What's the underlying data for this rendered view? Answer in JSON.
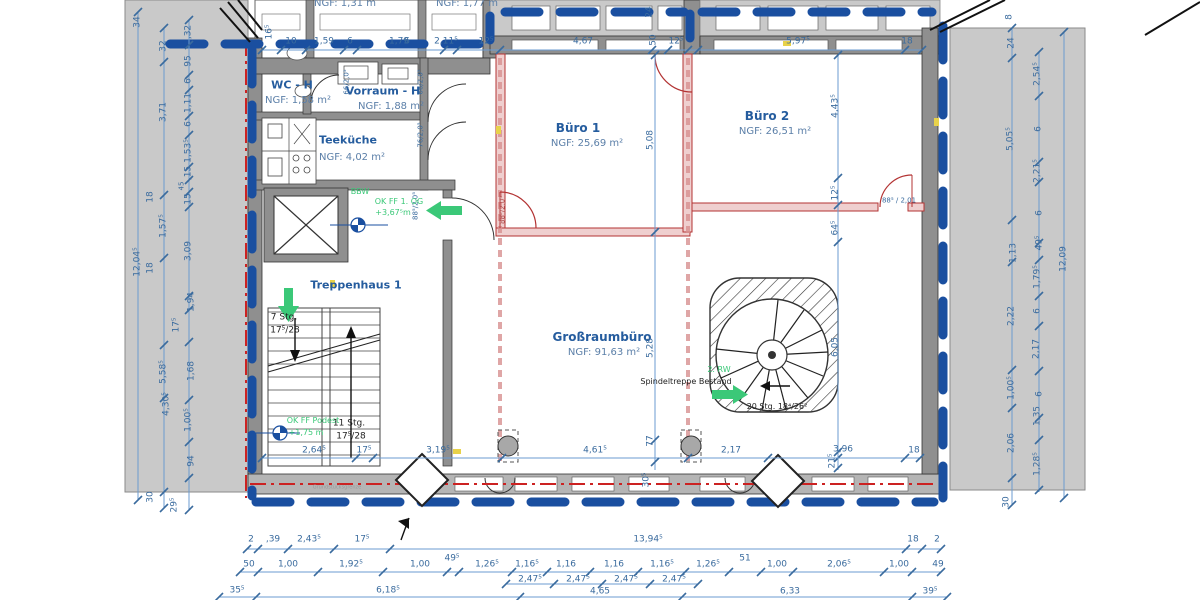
{
  "palette": {
    "d": "#3a6b9e",
    "r": "#255c9e",
    "n": "#5b7fa8",
    "g": "#3bc878",
    "k": "#222222",
    "y": "#999999",
    "p": "#b05050"
  },
  "colors": {
    "envelope_blue": "#1a4fa0",
    "property_line_red": "#cc2222",
    "wall_gray": "#8f8f8f",
    "parapet_gray": "#c9c9c9",
    "neighbor_gray": "#c9c9c9",
    "new_wall_red": "#b33333",
    "dim_line": "#6b9bd0",
    "accent_yellow": "#e8d24a",
    "green": "#3bc878"
  },
  "rooms": [
    {
      "name": "WC - H",
      "ngf": "NGF: 1,58 m²"
    },
    {
      "name": "Vorraum - H",
      "ngf": "NGF: 1,88 m²"
    },
    {
      "name": "Teeküche",
      "ngf": "NGF: 4,02 m²"
    },
    {
      "name": "Büro 1",
      "ngf": "NGF: 25,69 m²"
    },
    {
      "name": "Büro 2",
      "ngf": "NGF: 26,51 m²"
    },
    {
      "name": "Großraumbüro",
      "ngf": "NGF: 91,63 m²"
    },
    {
      "name": "Treppenhaus 1",
      "ngf": ""
    }
  ],
  "labels": [
    {
      "t": "NGF: 1,31 m",
      "x": 345,
      "y": 4,
      "s": 10,
      "c": "n",
      "n": "ngf-top-room-1"
    },
    {
      "t": "NGF: 1,77 m",
      "x": 467,
      "y": 4,
      "s": 10,
      "c": "n",
      "n": "ngf-top-room-2"
    },
    {
      "t": "16⁵",
      "x": 270,
      "y": 32,
      "v": 1
    },
    {
      "t": "10",
      "x": 291,
      "y": 42
    },
    {
      "t": "1,59",
      "x": 324,
      "y": 42
    },
    {
      "t": "6",
      "x": 350,
      "y": 42
    },
    {
      "t": "1,79",
      "x": 399,
      "y": 42
    },
    {
      "t": "6",
      "x": 407,
      "y": 42
    },
    {
      "t": "2,11⁵",
      "x": 446,
      "y": 42
    },
    {
      "t": "12⁵",
      "x": 486,
      "y": 42
    },
    {
      "t": "4,67",
      "x": 583,
      "y": 42
    },
    {
      "t": "50",
      "x": 654,
      "y": 40,
      "v": 1
    },
    {
      "t": "12⁵",
      "x": 676,
      "y": 42
    },
    {
      "t": "5,97⁵",
      "x": 798,
      "y": 42
    },
    {
      "t": "18",
      "x": 907,
      "y": 42
    },
    {
      "t": "24",
      "x": 650,
      "y": 12,
      "v": 1
    },
    {
      "t": "66/2,0⁵",
      "x": 347,
      "y": 82,
      "s": 7,
      "v": 1,
      "n": "door-size-label"
    },
    {
      "t": "66/2,0⁵",
      "x": 421,
      "y": 82,
      "s": 7,
      "v": 1,
      "n": "door-size-label"
    },
    {
      "t": "76/2,0⁵",
      "x": 421,
      "y": 135,
      "s": 7,
      "v": 1,
      "n": "door-size-label"
    },
    {
      "t": "88⁵/2,0⁵",
      "x": 416,
      "y": 206,
      "s": 7,
      "v": 1,
      "n": "door-size-label"
    },
    {
      "t": "88⁵/2,0⁵",
      "x": 503,
      "y": 210,
      "s": 7,
      "v": 1,
      "c": "p",
      "n": "door-size-label"
    },
    {
      "t": "88⁵ / 2,01",
      "x": 899,
      "y": 201,
      "s": 7,
      "n": "door-size-label"
    },
    {
      "t": "WC - H",
      "x": 292,
      "y": 85,
      "s": 11,
      "c": "r",
      "b": 1,
      "n": "room-label-wc-h"
    },
    {
      "t": "NGF: 1,58 m²",
      "x": 298,
      "y": 101,
      "s": 10,
      "c": "n",
      "n": "room-area-wc-h"
    },
    {
      "t": "Vorraum - H",
      "x": 383,
      "y": 91,
      "s": 11,
      "c": "r",
      "b": 1,
      "n": "room-label-vorraum-h"
    },
    {
      "t": "NGF: 1,88 m²",
      "x": 391,
      "y": 107,
      "s": 10,
      "c": "n",
      "n": "room-area-vorraum-h"
    },
    {
      "t": "Teeküche",
      "x": 348,
      "y": 140,
      "s": 11,
      "c": "r",
      "b": 1,
      "n": "room-label-teekueche"
    },
    {
      "t": "NGF: 4,02 m²",
      "x": 352,
      "y": 158,
      "s": 10,
      "c": "n",
      "n": "room-area-teekueche"
    },
    {
      "t": "Büro 1",
      "x": 578,
      "y": 128,
      "s": 12,
      "c": "r",
      "b": 1,
      "n": "room-label-buero-1"
    },
    {
      "t": "NGF: 25,69 m²",
      "x": 587,
      "y": 144,
      "s": 10,
      "c": "n",
      "n": "room-area-buero-1"
    },
    {
      "t": "Büro 2",
      "x": 767,
      "y": 116,
      "s": 12,
      "c": "r",
      "b": 1,
      "n": "room-label-buero-2"
    },
    {
      "t": "NGF: 26,51 m²",
      "x": 775,
      "y": 132,
      "s": 10,
      "c": "n",
      "n": "room-area-buero-2"
    },
    {
      "t": "Großraumbüro",
      "x": 602,
      "y": 337,
      "s": 12,
      "c": "r",
      "b": 1,
      "n": "room-label-grossraumbuero"
    },
    {
      "t": "NGF: 91,63 m²",
      "x": 604,
      "y": 353,
      "s": 10,
      "c": "n",
      "n": "room-area-grossraumbuero"
    },
    {
      "t": "Treppenhaus 1",
      "x": 356,
      "y": 285,
      "s": 11,
      "c": "r",
      "b": 1,
      "n": "room-label-treppenhaus-1"
    },
    {
      "t": "BBW",
      "x": 360,
      "y": 192,
      "s": 8,
      "c": "g",
      "n": "note-bbw"
    },
    {
      "t": "OK FF 1. OG",
      "x": 399,
      "y": 202,
      "s": 8,
      "c": "g",
      "n": "level-note-ok-ff-1og"
    },
    {
      "t": "+3,67⁵m",
      "x": 393,
      "y": 213,
      "s": 8,
      "c": "g",
      "n": "level-value-1og"
    },
    {
      "t": "OK FF Podest",
      "x": 313,
      "y": 421,
      "s": 8,
      "c": "g",
      "n": "level-note-podest"
    },
    {
      "t": "+1,75 m",
      "x": 306,
      "y": 433,
      "s": 8,
      "c": "g",
      "n": "level-value-podest"
    },
    {
      "t": "7 Stg.",
      "x": 284,
      "y": 318,
      "s": 9,
      "c": "k",
      "n": "stair-note-7stg"
    },
    {
      "t": "17⁵/28",
      "x": 285,
      "y": 331,
      "s": 9,
      "c": "k",
      "n": "stair-note-7stg-dim"
    },
    {
      "t": "11 Stg.",
      "x": 349,
      "y": 424,
      "s": 9,
      "c": "k",
      "n": "stair-note-11stg"
    },
    {
      "t": "17⁵/28",
      "x": 351,
      "y": 437,
      "s": 9,
      "c": "k",
      "n": "stair-note-11stg-dim"
    },
    {
      "t": "2. RW",
      "x": 719,
      "y": 370,
      "s": 8,
      "c": "g",
      "n": "note-2-rw"
    },
    {
      "t": "Spindeltreppe Bestand",
      "x": 686,
      "y": 382,
      "s": 8,
      "c": "k",
      "n": "note-spindeltreppe"
    },
    {
      "t": "20 Stg. 18⁴/26²",
      "x": 777,
      "y": 407,
      "s": 8,
      "c": "k",
      "n": "stair-note-20stg"
    },
    {
      "t": "Grundstücksgrenze",
      "x": 337,
      "y": 488,
      "s": 5,
      "c": "y",
      "n": "note-grundstuecksgrenze"
    },
    {
      "t": "5,08",
      "x": 651,
      "y": 140,
      "v": 1
    },
    {
      "t": "5,28",
      "x": 651,
      "y": 348,
      "v": 1
    },
    {
      "t": "77",
      "x": 651,
      "y": 441,
      "v": 1
    },
    {
      "t": "30⁵",
      "x": 647,
      "y": 480,
      "v": 1
    },
    {
      "t": "4,43⁵",
      "x": 836,
      "y": 106,
      "v": 1
    },
    {
      "t": "12⁵",
      "x": 836,
      "y": 193,
      "v": 1
    },
    {
      "t": "64⁵",
      "x": 836,
      "y": 228,
      "v": 1
    },
    {
      "t": "6,05",
      "x": 836,
      "y": 347,
      "v": 1
    },
    {
      "t": "21⁵",
      "x": 833,
      "y": 461,
      "v": 1
    },
    {
      "t": "2,64⁵",
      "x": 314,
      "y": 451
    },
    {
      "t": "17⁵",
      "x": 364,
      "y": 451
    },
    {
      "t": "3,19⁵",
      "x": 438,
      "y": 451
    },
    {
      "t": "4,61⁵",
      "x": 595,
      "y": 451
    },
    {
      "t": "2,17",
      "x": 731,
      "y": 451
    },
    {
      "t": "3,96",
      "x": 843,
      "y": 450
    },
    {
      "t": "18",
      "x": 914,
      "y": 451
    },
    {
      "t": "34",
      "x": 138,
      "y": 22,
      "v": 1
    },
    {
      "t": "12,04⁵",
      "x": 138,
      "y": 262,
      "v": 1
    },
    {
      "t": "32",
      "x": 164,
      "y": 46,
      "v": 1
    },
    {
      "t": "3,71",
      "x": 164,
      "y": 112,
      "v": 1
    },
    {
      "t": "1,57⁵",
      "x": 164,
      "y": 226,
      "v": 1
    },
    {
      "t": "18",
      "x": 151,
      "y": 197,
      "v": 1
    },
    {
      "t": "18",
      "x": 151,
      "y": 268,
      "v": 1
    },
    {
      "t": "5,58⁵",
      "x": 164,
      "y": 372,
      "v": 1
    },
    {
      "t": "4,30⁵",
      "x": 167,
      "y": 404,
      "v": 1
    },
    {
      "t": "30",
      "x": 151,
      "y": 497,
      "v": 1
    },
    {
      "t": ",32",
      "x": 189,
      "y": 32,
      "v": 1
    },
    {
      "t": "95",
      "x": 189,
      "y": 61,
      "v": 1
    },
    {
      "t": "6",
      "x": 189,
      "y": 81,
      "v": 1
    },
    {
      "t": "1,11",
      "x": 189,
      "y": 103,
      "v": 1
    },
    {
      "t": "6",
      "x": 189,
      "y": 124,
      "v": 1
    },
    {
      "t": "1,53⁵",
      "x": 189,
      "y": 151,
      "v": 1
    },
    {
      "t": ",15",
      "x": 189,
      "y": 173,
      "v": 1
    },
    {
      "t": "45",
      "x": 182,
      "y": 186,
      "s": 7,
      "v": 1
    },
    {
      "t": "15",
      "x": 189,
      "y": 199,
      "v": 1
    },
    {
      "t": "3,09",
      "x": 189,
      "y": 251,
      "v": 1
    },
    {
      "t": "1,94",
      "x": 192,
      "y": 302,
      "v": 1
    },
    {
      "t": "17⁵",
      "x": 177,
      "y": 325,
      "v": 1
    },
    {
      "t": "1,68",
      "x": 192,
      "y": 371,
      "v": 1
    },
    {
      "t": "1,00⁵",
      "x": 189,
      "y": 420,
      "v": 1
    },
    {
      "t": "94",
      "x": 192,
      "y": 461,
      "v": 1
    },
    {
      "t": "29⁵",
      "x": 175,
      "y": 505,
      "v": 1
    },
    {
      "t": "8",
      "x": 1010,
      "y": 17,
      "v": 1
    },
    {
      "t": "24",
      "x": 1012,
      "y": 43,
      "v": 1
    },
    {
      "t": "5,05⁵",
      "x": 1011,
      "y": 139,
      "v": 1
    },
    {
      "t": "1,13",
      "x": 1014,
      "y": 253,
      "v": 1
    },
    {
      "t": "2,22",
      "x": 1012,
      "y": 316,
      "v": 1
    },
    {
      "t": "1,00⁵",
      "x": 1012,
      "y": 388,
      "v": 1
    },
    {
      "t": "2,06",
      "x": 1012,
      "y": 443,
      "v": 1
    },
    {
      "t": "30",
      "x": 1007,
      "y": 502,
      "v": 1
    },
    {
      "t": "2,54⁵",
      "x": 1038,
      "y": 74,
      "v": 1
    },
    {
      "t": "6",
      "x": 1039,
      "y": 129,
      "v": 1
    },
    {
      "t": "2,21⁵",
      "x": 1038,
      "y": 171,
      "v": 1
    },
    {
      "t": "6",
      "x": 1040,
      "y": 213,
      "v": 1
    },
    {
      "t": "49⁵",
      "x": 1040,
      "y": 243,
      "v": 1
    },
    {
      "t": "1,79⁵",
      "x": 1038,
      "y": 277,
      "v": 1
    },
    {
      "t": "6",
      "x": 1038,
      "y": 311,
      "v": 1
    },
    {
      "t": "2,17",
      "x": 1037,
      "y": 349,
      "v": 1
    },
    {
      "t": "6",
      "x": 1040,
      "y": 394,
      "v": 1
    },
    {
      "t": "1,35",
      "x": 1038,
      "y": 416,
      "v": 1
    },
    {
      "t": "1,28⁵",
      "x": 1038,
      "y": 464,
      "v": 1
    },
    {
      "t": "12,09",
      "x": 1064,
      "y": 259,
      "v": 1
    },
    {
      "t": "2",
      "x": 251,
      "y": 540
    },
    {
      "t": ",39",
      "x": 273,
      "y": 540
    },
    {
      "t": "2,43⁵",
      "x": 309,
      "y": 540
    },
    {
      "t": "17⁵",
      "x": 362,
      "y": 540
    },
    {
      "t": "13,94⁵",
      "x": 648,
      "y": 540
    },
    {
      "t": "18",
      "x": 913,
      "y": 540
    },
    {
      "t": "2",
      "x": 937,
      "y": 540
    },
    {
      "t": "50",
      "x": 249,
      "y": 565
    },
    {
      "t": "1,00",
      "x": 288,
      "y": 565
    },
    {
      "t": "1,92⁵",
      "x": 351,
      "y": 565
    },
    {
      "t": "1,00",
      "x": 420,
      "y": 565
    },
    {
      "t": "49⁵",
      "x": 452,
      "y": 559
    },
    {
      "t": "1,26⁵",
      "x": 487,
      "y": 565
    },
    {
      "t": "1,16⁵",
      "x": 527,
      "y": 565
    },
    {
      "t": "1,16",
      "x": 566,
      "y": 565
    },
    {
      "t": "1,16",
      "x": 614,
      "y": 565
    },
    {
      "t": "1,16⁵",
      "x": 662,
      "y": 565
    },
    {
      "t": "1,26⁵",
      "x": 708,
      "y": 565
    },
    {
      "t": "51",
      "x": 745,
      "y": 559
    },
    {
      "t": "1,00",
      "x": 777,
      "y": 565
    },
    {
      "t": "2,06⁵",
      "x": 839,
      "y": 565
    },
    {
      "t": "1,00",
      "x": 899,
      "y": 565
    },
    {
      "t": "49",
      "x": 938,
      "y": 565
    },
    {
      "t": "2,47⁵",
      "x": 530,
      "y": 580
    },
    {
      "t": "2,47⁵",
      "x": 578,
      "y": 580
    },
    {
      "t": "2,47⁵",
      "x": 626,
      "y": 580
    },
    {
      "t": "2,47⁵",
      "x": 674,
      "y": 580
    },
    {
      "t": "35⁵",
      "x": 237,
      "y": 591
    },
    {
      "t": "6,18⁵",
      "x": 388,
      "y": 591
    },
    {
      "t": "4,65",
      "x": 600,
      "y": 592
    },
    {
      "t": "6,33",
      "x": 790,
      "y": 592
    },
    {
      "t": "39⁵",
      "x": 930,
      "y": 592
    }
  ],
  "dim_lines": [
    {
      "o": "h",
      "p": 50,
      "a": 262,
      "b": 922,
      "t": [
        262,
        281,
        306,
        344,
        357,
        444,
        457,
        500,
        652,
        668,
        688,
        698,
        905,
        922
      ]
    },
    {
      "o": "h",
      "p": 458,
      "a": 262,
      "b": 920,
      "t": [
        262,
        356,
        373,
        502,
        688,
        768,
        838,
        905,
        920
      ]
    },
    {
      "o": "h",
      "p": 549,
      "a": 247,
      "b": 941,
      "t": [
        247,
        258,
        288,
        334,
        390,
        906,
        922,
        941
      ]
    },
    {
      "o": "h",
      "p": 572,
      "a": 240,
      "b": 941,
      "t": [
        240,
        258,
        318,
        383,
        447,
        459,
        512,
        547,
        590,
        638,
        685,
        729,
        761,
        793,
        884,
        912,
        941
      ]
    },
    {
      "o": "h",
      "p": 584,
      "a": 506,
      "b": 698,
      "t": [
        506,
        554,
        602,
        650,
        698
      ]
    },
    {
      "o": "h",
      "p": 597,
      "a": 219,
      "b": 947,
      "t": [
        219,
        256,
        520,
        682,
        912,
        947
      ]
    },
    {
      "o": "v",
      "p": 655,
      "a": 55,
      "b": 470,
      "t": [
        55,
        232,
        440,
        462
      ]
    },
    {
      "o": "v",
      "p": 838,
      "a": 55,
      "b": 470,
      "t": [
        55,
        178,
        205,
        242,
        452,
        468
      ]
    },
    {
      "o": "v",
      "p": 138,
      "a": 12,
      "b": 500,
      "t": [
        12,
        500
      ]
    },
    {
      "o": "v",
      "p": 164,
      "a": 28,
      "b": 508,
      "t": [
        28,
        62,
        195,
        258,
        345,
        398,
        492,
        508
      ]
    },
    {
      "o": "v",
      "p": 189,
      "a": 20,
      "b": 510,
      "t": [
        20,
        45,
        75,
        90,
        116,
        135,
        167,
        180,
        192,
        207,
        296,
        310,
        342,
        400,
        442,
        478,
        510
      ]
    },
    {
      "o": "v",
      "p": 1012,
      "a": 28,
      "b": 505,
      "t": [
        28,
        58,
        220,
        262,
        370,
        408,
        478,
        505
      ]
    },
    {
      "o": "v",
      "p": 1039,
      "a": 52,
      "b": 492,
      "t": [
        52,
        96,
        162,
        182,
        243,
        260,
        296,
        326,
        371,
        418,
        440,
        490
      ]
    },
    {
      "o": "v",
      "p": 1064,
      "a": 32,
      "b": 498,
      "t": [
        32,
        498
      ]
    }
  ]
}
